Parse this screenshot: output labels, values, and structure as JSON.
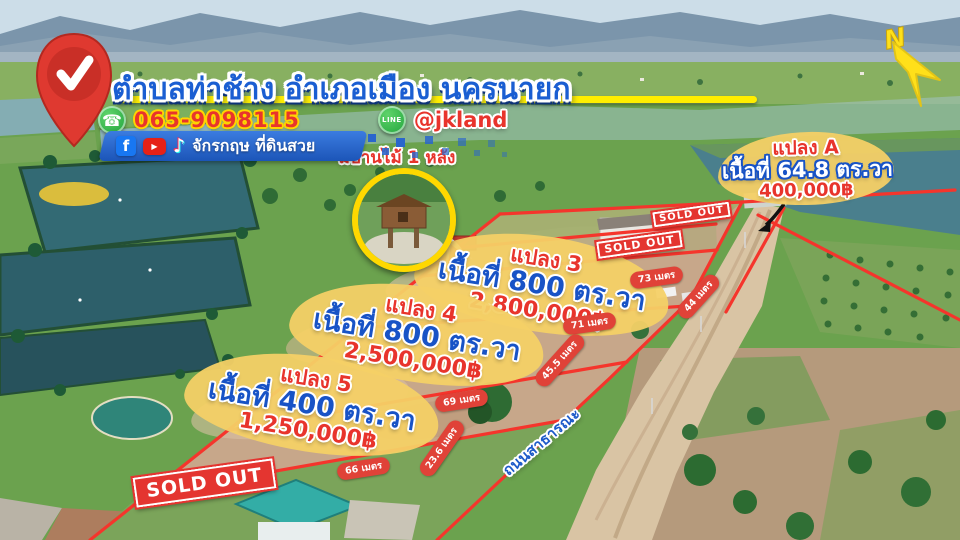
{
  "location_banner": {
    "title": "ตำบลท่าช้าง  อำเภอเมือง นครนายก",
    "phone": "065-9098115",
    "line_icon_text": "LINE",
    "line_id": "@jkland",
    "channel_name": "จักรกฤษ ที่ดินสวย"
  },
  "callout": {
    "text": "มีบ้านไม้ 1 หลัง"
  },
  "compass": {
    "label": "N"
  },
  "road": {
    "label": "ถนนสาธารณะ"
  },
  "plots": [
    {
      "name": "แปลง A",
      "area": "เนื้อที่ 64.8 ตร.วา",
      "price": "400,000฿"
    },
    {
      "name": "แปลง 3",
      "area": "เนื้อที่ 800 ตร.วา",
      "price": "2,800,000฿"
    },
    {
      "name": "แปลง 4",
      "area": "เนื้อที่ 800 ตร.วา",
      "price": "2,500,000฿"
    },
    {
      "name": "แปลง 5",
      "area": "เนื้อที่ 400 ตร.วา",
      "price": "1,250,000฿"
    }
  ],
  "sold_out": {
    "label": "SOLD OUT"
  },
  "measurements": [
    "73 เมตร",
    "44 เมตร",
    "71 เมตร",
    "45.5 เมตร",
    "69 เมตร",
    "23.6 เมตร",
    "66 เมตร"
  ],
  "colors": {
    "accent_red": "#e8342c",
    "accent_blue": "#1853c6",
    "accent_yellow": "#ffee00",
    "banner_blue": "#2a6fd8",
    "boundary_red": "#f5352c",
    "blob_yellow": "#f3d06a"
  }
}
